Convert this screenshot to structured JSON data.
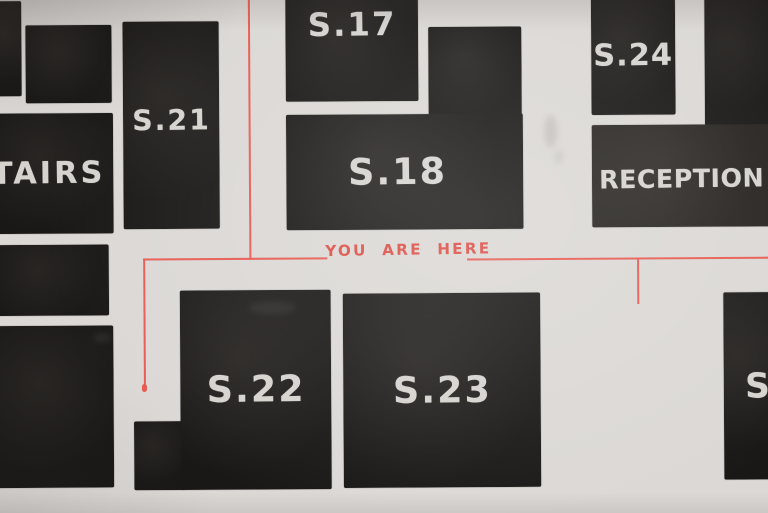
{
  "map": {
    "title_context": "hand-painted gallery floor plan",
    "marker": {
      "label": "YOU ARE HERE"
    },
    "rooms": [
      {
        "id": "stairs",
        "label": "TAIRS"
      },
      {
        "id": "s17",
        "label": "S.17"
      },
      {
        "id": "s18",
        "label": "S.18"
      },
      {
        "id": "s21",
        "label": "S.21"
      },
      {
        "id": "s22",
        "label": "S.22"
      },
      {
        "id": "s23",
        "label": "S.23"
      },
      {
        "id": "s24",
        "label": "S.24"
      },
      {
        "id": "s25-partialения",
        "label": "S"
      },
      {
        "id": "reception",
        "label": "RECEPTION"
      }
    ],
    "colors": {
      "background": "#dbd8d5",
      "room_fill": "#1a1817",
      "room_label": "#d6d3cf",
      "path_red": "#e8564d"
    }
  }
}
